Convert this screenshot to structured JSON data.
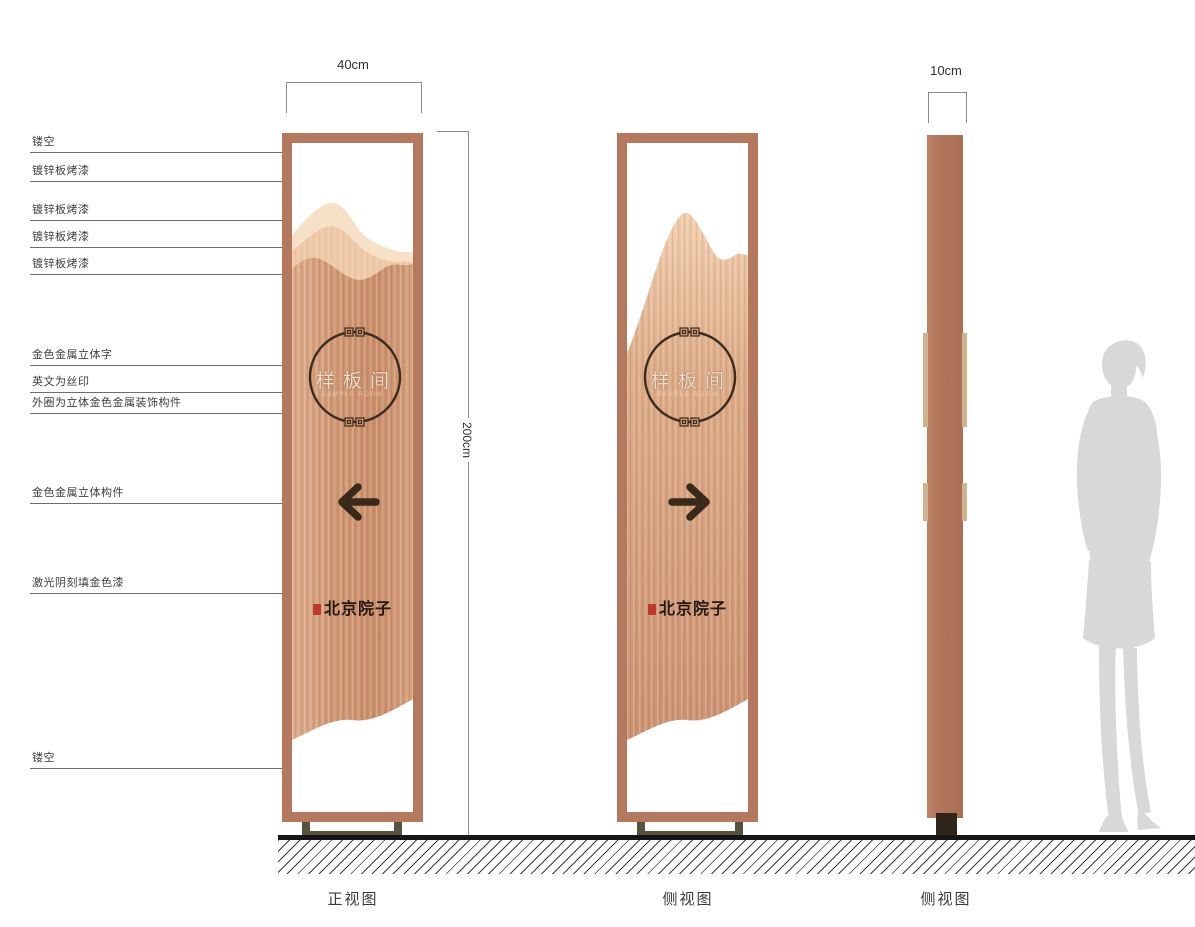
{
  "annotations": [
    {
      "label": "镂空"
    },
    {
      "label": "镀锌板烤漆"
    },
    {
      "label": "镀锌板烤漆"
    },
    {
      "label": "镀锌板烤漆"
    },
    {
      "label": "镀锌板烤漆"
    },
    {
      "label": "金色金属立体字"
    },
    {
      "label": "英文为丝印"
    },
    {
      "label": "外圈为立体金色金属装饰构件"
    },
    {
      "label": "金色金属立体构件"
    },
    {
      "label": "激光阴刻填金色漆"
    },
    {
      "label": "镂空"
    }
  ],
  "dimensions": {
    "front_width": "40cm",
    "height": "200cm",
    "side_width": "10cm"
  },
  "sign": {
    "room_name": "样板间",
    "room_name_en": "SAMPLE ROOM",
    "brand": "北京院子"
  },
  "views": {
    "front_label": "正视图",
    "back_label": "侧视图",
    "side_label": "侧视图"
  },
  "colors": {
    "frame_copper": "#b4785c",
    "panel_copper": "#d09672",
    "mountain_light": "#f6e0c6",
    "mountain_mid": "#eecaa8",
    "accent_dark": "#3a2b1d",
    "seal_red": "#c03a2b",
    "base_olive": "#57513f",
    "silhouette_gray": "#d8d8d8"
  }
}
